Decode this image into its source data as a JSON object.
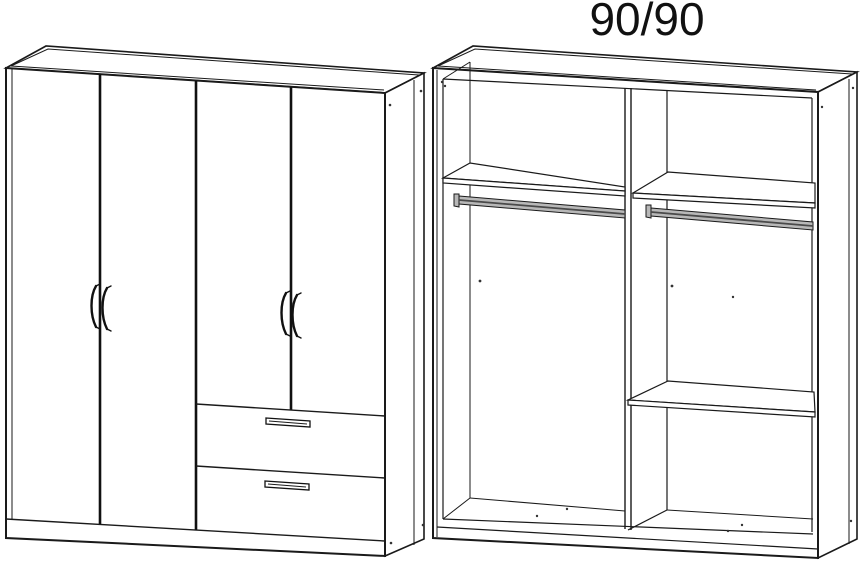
{
  "title": {
    "label": "90/90"
  },
  "diagram": {
    "type": "wardrobe-technical-line-drawing",
    "background_color": "#ffffff",
    "line_color": "#1a1a1a",
    "views": [
      {
        "id": "closed-front-view",
        "position": "left",
        "description": "Wardrobe exterior shown closed in front-left perspective",
        "doors": 4,
        "drawers": 2,
        "door_handles": 4,
        "drawer_handles": 2,
        "plinth": true
      },
      {
        "id": "open-interior-view",
        "position": "right",
        "description": "Wardrobe interior shown without doors",
        "compartments": 2,
        "top_shelves": 2,
        "hanging_rails": 2,
        "extra_shelves_right_compartment": 1,
        "center_divider": true,
        "plinth": true
      }
    ]
  }
}
